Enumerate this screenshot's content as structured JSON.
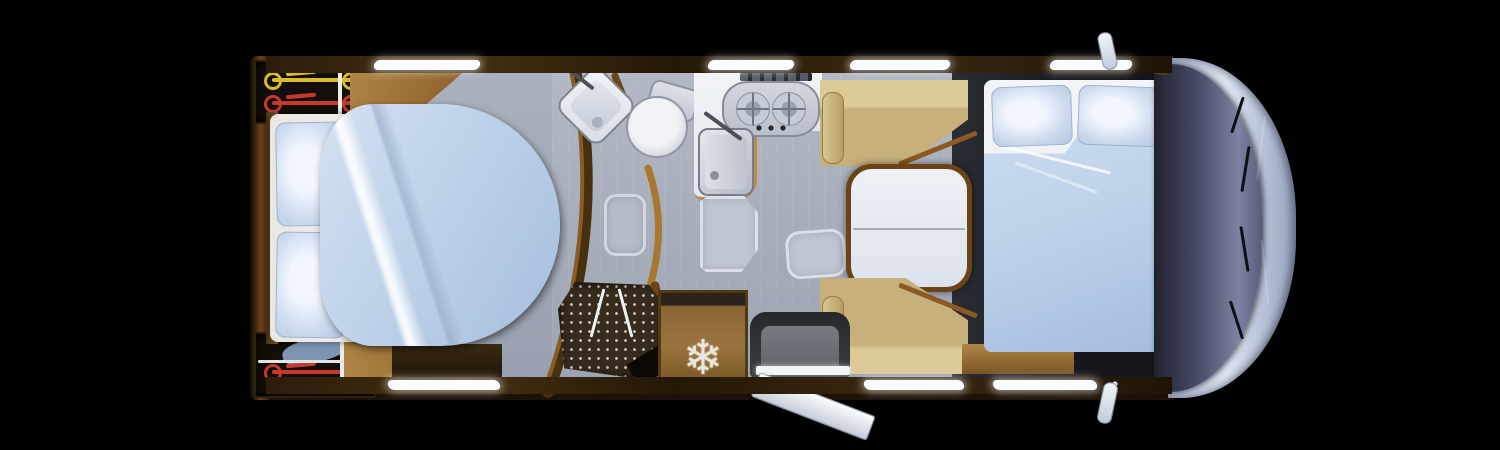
{
  "scene": {
    "type": "motorhome-floorplan-top-view",
    "description": "Top-down rendered floor plan of a motorhome, front of vehicle on the right, on a black background",
    "door_state": "entry-door-open",
    "window_count_top": 4,
    "window_count_bottom": 3
  },
  "palette": {
    "bg": "#000000",
    "sheet": "#f4f5f8",
    "duvet": "#bed2ea",
    "pillow": "#c8d8ee",
    "bench": "#c7b07c",
    "table": "#dde3ed",
    "fridge": "#9a7440",
    "shower_dot": "#cfc6b6",
    "cap": "#9aa6c2",
    "glass": "#7d82a2",
    "window": "#fafcff",
    "wood": "#8a5c28",
    "floor_gray": "#a9aeba",
    "bike_yellow": "#d8bc2a",
    "bike_red": "#c53a2c",
    "bike_blue": "#8aa4c6"
  },
  "rooms": {
    "rear_bedroom": {
      "label": "Rear island bed",
      "items": [
        "double-bed",
        "two-pillows",
        "duvet",
        "bike-garage-top",
        "bike-garage-bottom",
        "wardrobe"
      ]
    },
    "bathroom": {
      "label": "Bathroom",
      "items": [
        "corner-washbasin",
        "toilet",
        "bath-mat",
        "shower"
      ]
    },
    "kitchen": {
      "label": "Kitchen",
      "items": [
        "two-burner-hob",
        "kitchen-sink",
        "refrigerator"
      ]
    },
    "dinette": {
      "label": "Dinette",
      "items": [
        "bench-seat-top",
        "folding-table",
        "bench-seat-bottom",
        "travel-seat",
        "entry-door",
        "entry-step",
        "floor-mats"
      ]
    },
    "front_bed": {
      "label": "Drop-down front double bed",
      "items": [
        "double-bed",
        "two-pillows",
        "duvet"
      ]
    },
    "cab": {
      "label": "Driver cab",
      "items": [
        "windshield",
        "wipers",
        "front-cap",
        "side-mirror-top",
        "side-mirror-bottom"
      ]
    }
  },
  "icons": {
    "refrigerator": {
      "name": "snowflake-icon",
      "glyph": "❄"
    }
  }
}
